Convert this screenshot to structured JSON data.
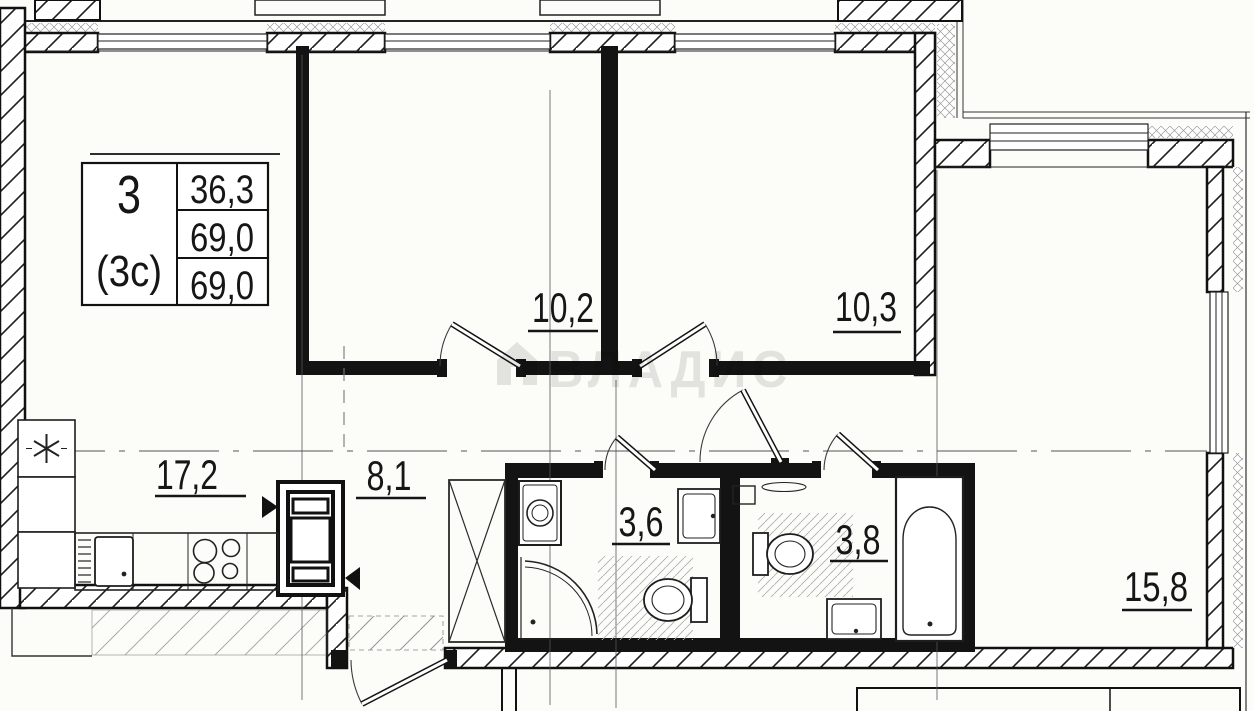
{
  "info_table": {
    "rooms_count": "3",
    "type_label": "(3c)",
    "living_area": "36,3",
    "area_without_balcony": "69,0",
    "total_area": "69,0"
  },
  "watermark": {
    "text": "ВЛАДИС",
    "icon": "house-icon"
  },
  "rooms": [
    {
      "name": "kitchen-living-room",
      "area": "17,2"
    },
    {
      "name": "bedroom-1",
      "area": "10,2"
    },
    {
      "name": "bedroom-2",
      "area": "10,3"
    },
    {
      "name": "hallway",
      "area": "8,1"
    },
    {
      "name": "bathroom",
      "area": "3,6"
    },
    {
      "name": "toilet-bathroom",
      "area": "3,8"
    },
    {
      "name": "room",
      "area": "15,8"
    }
  ],
  "fixtures": [
    "fridge",
    "kitchen-sink",
    "stove",
    "vent-shaft",
    "wardrobe",
    "washing-machine",
    "shower",
    "toilet",
    "wall-sink",
    "bathtub",
    "shelf"
  ],
  "colors": {
    "line": "#111111",
    "wall_hatch": "#1a1a1a",
    "insulation_hatch": "#9a9a9a",
    "floor_hatch": "#b0b0b0",
    "watermark": "#e5e5e5",
    "background": "#fcfcf9"
  }
}
